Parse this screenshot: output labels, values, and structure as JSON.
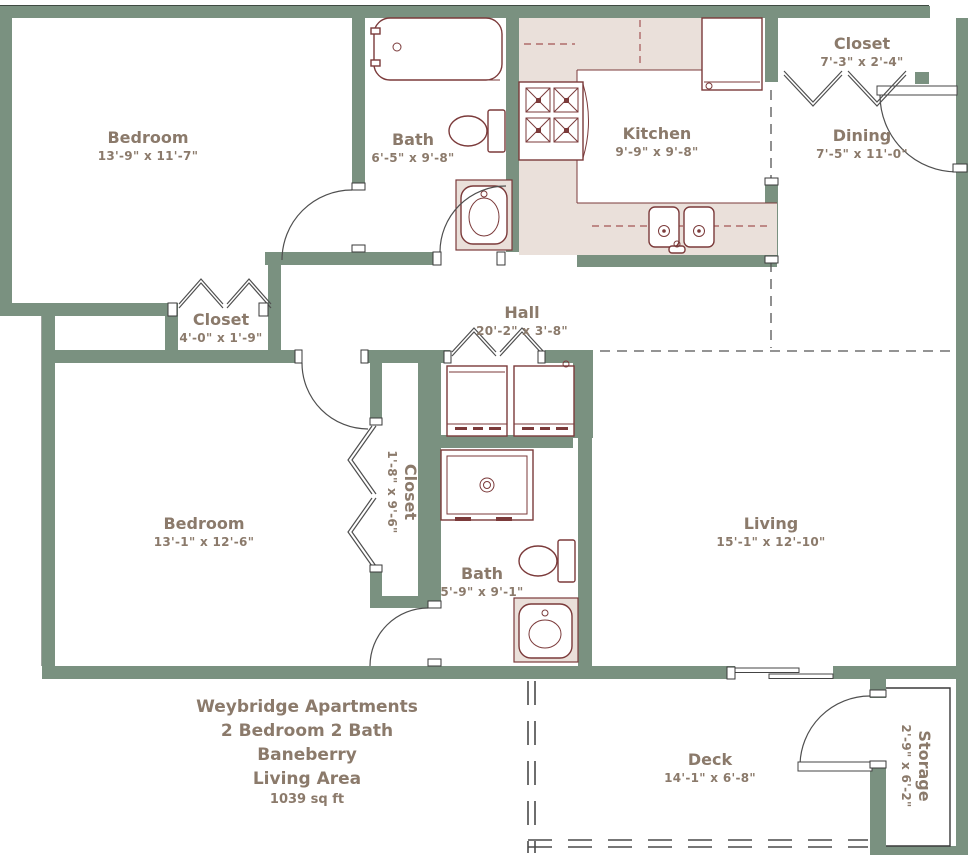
{
  "plan": {
    "type": "apartment-floor-plan",
    "rooms": [
      {
        "id": "bedroom-1",
        "name": "Bedroom",
        "dims": "13'-9\" x 11'-7\""
      },
      {
        "id": "bath-1",
        "name": "Bath",
        "dims": "6'-5\" x 9'-8\""
      },
      {
        "id": "kitchen",
        "name": "Kitchen",
        "dims": "9'-9\" x 9'-8\""
      },
      {
        "id": "closet-entry",
        "name": "Closet",
        "dims": "7'-3\" x 2'-4\""
      },
      {
        "id": "dining",
        "name": "Dining",
        "dims": "7'-5\" x 11'-0\""
      },
      {
        "id": "closet-hall",
        "name": "Closet",
        "dims": "4'-0\" x 1'-9\""
      },
      {
        "id": "hall",
        "name": "Hall",
        "dims": "20'-2\" x 3'-8\""
      },
      {
        "id": "bedroom-2",
        "name": "Bedroom",
        "dims": "13'-1\" x 12'-6\""
      },
      {
        "id": "closet-bedroom-2",
        "name": "Closet",
        "dims": "1'-8\" x 9'-6\"",
        "orientation": "vertical"
      },
      {
        "id": "bath-2",
        "name": "Bath",
        "dims": "5'-9\" x 9'-1\""
      },
      {
        "id": "living",
        "name": "Living",
        "dims": "15'-1\" x 12'-10\""
      },
      {
        "id": "deck",
        "name": "Deck",
        "dims": "14'-1\" x 6'-8\""
      },
      {
        "id": "storage",
        "name": "Storage",
        "dims": "2'-9\" x 6'-2\"",
        "orientation": "vertical"
      }
    ],
    "title_block": {
      "property": "Weybridge Apartments",
      "unit_type": "2 Bedroom 2 Bath",
      "plan_name": "Baneberry",
      "area_label": "Living Area",
      "area_value": "1039 sq ft"
    },
    "colors": {
      "wall": "#7a9180",
      "fixture_line": "#7b3a3a",
      "counter_fill": "#eae0da",
      "label_text": "#8b7a6b",
      "door_line": "#4f4f4f",
      "background": "#ffffff"
    },
    "fixtures": [
      "bathtub",
      "toilet",
      "pedestal-sink",
      "range",
      "refrigerator",
      "double-kitchen-sink",
      "washer",
      "dryer",
      "shower",
      "sliding-glass-door",
      "entry-door",
      "storage-door",
      "bifold-closet-doors"
    ]
  }
}
